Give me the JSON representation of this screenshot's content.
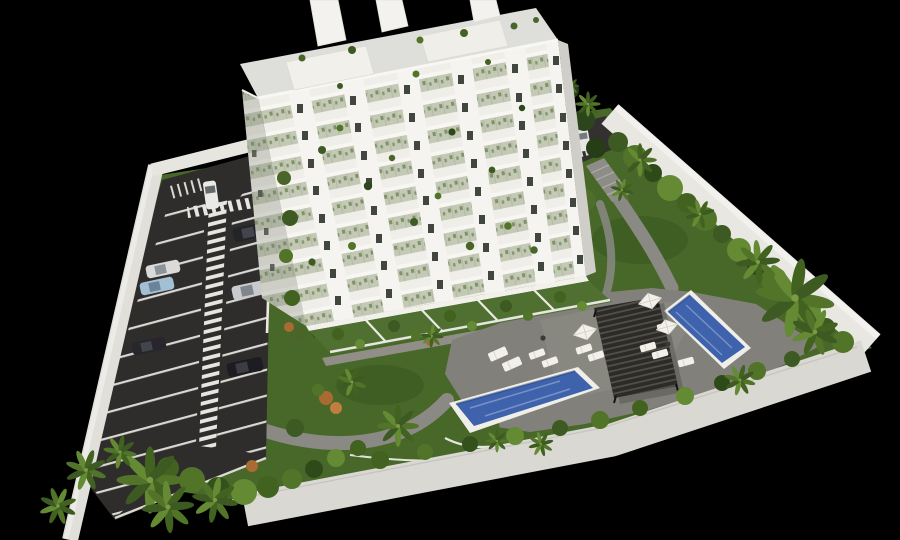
{
  "scene": {
    "title": "Aerial 3D architectural rendering of a white apartment block with landscaped grounds, two swimming pools and a striped parking lot",
    "background": "#000000",
    "palette": {
      "lawn": "#486829",
      "asphalt": "#2f2d2c",
      "deck": "#82807a",
      "pool_water": "#3e63ac",
      "pool_rim": "#efeee8",
      "wall": "#e0dfd9",
      "wall_bright": "#e8e7e2",
      "building_white": "#f5f4f0",
      "balcony_band": "#c3c9b4",
      "slab_white": "#f7f6f2",
      "pergola": "#2c2b27",
      "furniture": "#f2f0e9",
      "path": "#8b8984",
      "marking": "#deddd8",
      "hedge_dark": "#3c5a21",
      "hedge_light": "#648a33",
      "accent_shrub": "#a96a33"
    },
    "building": {
      "floors": 9,
      "window_columns": 6,
      "windows_per_column": 8,
      "penthouse_towers": 3,
      "ground_floor_gardens": 5,
      "balcony_planting": true
    },
    "parking": {
      "stall_columns": 2,
      "zebra_walkway": true,
      "cars": [
        {
          "id": "van",
          "color": "#e9e9e7"
        },
        {
          "id": "sedan-dark-1",
          "color": "#23232a"
        },
        {
          "id": "sedan-silver",
          "color": "#c9cacd"
        },
        {
          "id": "sedan-white",
          "color": "#d9dad9"
        },
        {
          "id": "sedan-lightblue",
          "color": "#a3bfd4"
        },
        {
          "id": "sedan-dark-2",
          "color": "#26262c"
        },
        {
          "id": "sedan-dark-3",
          "color": "#1c1c22"
        },
        {
          "id": "driveway-car",
          "color": "#e6e6e4"
        }
      ]
    },
    "pools": {
      "count": 2,
      "water": "#3e63ac",
      "rim": "#efeee8"
    },
    "amenities": {
      "pergolas": 1,
      "umbrellas": 3,
      "sun_loungers": 10,
      "side_tables": 2
    },
    "vegetation": {
      "palm_trees": 20,
      "wall_hedge_shrubs": 14,
      "lawn_shrubs": 21
    }
  }
}
